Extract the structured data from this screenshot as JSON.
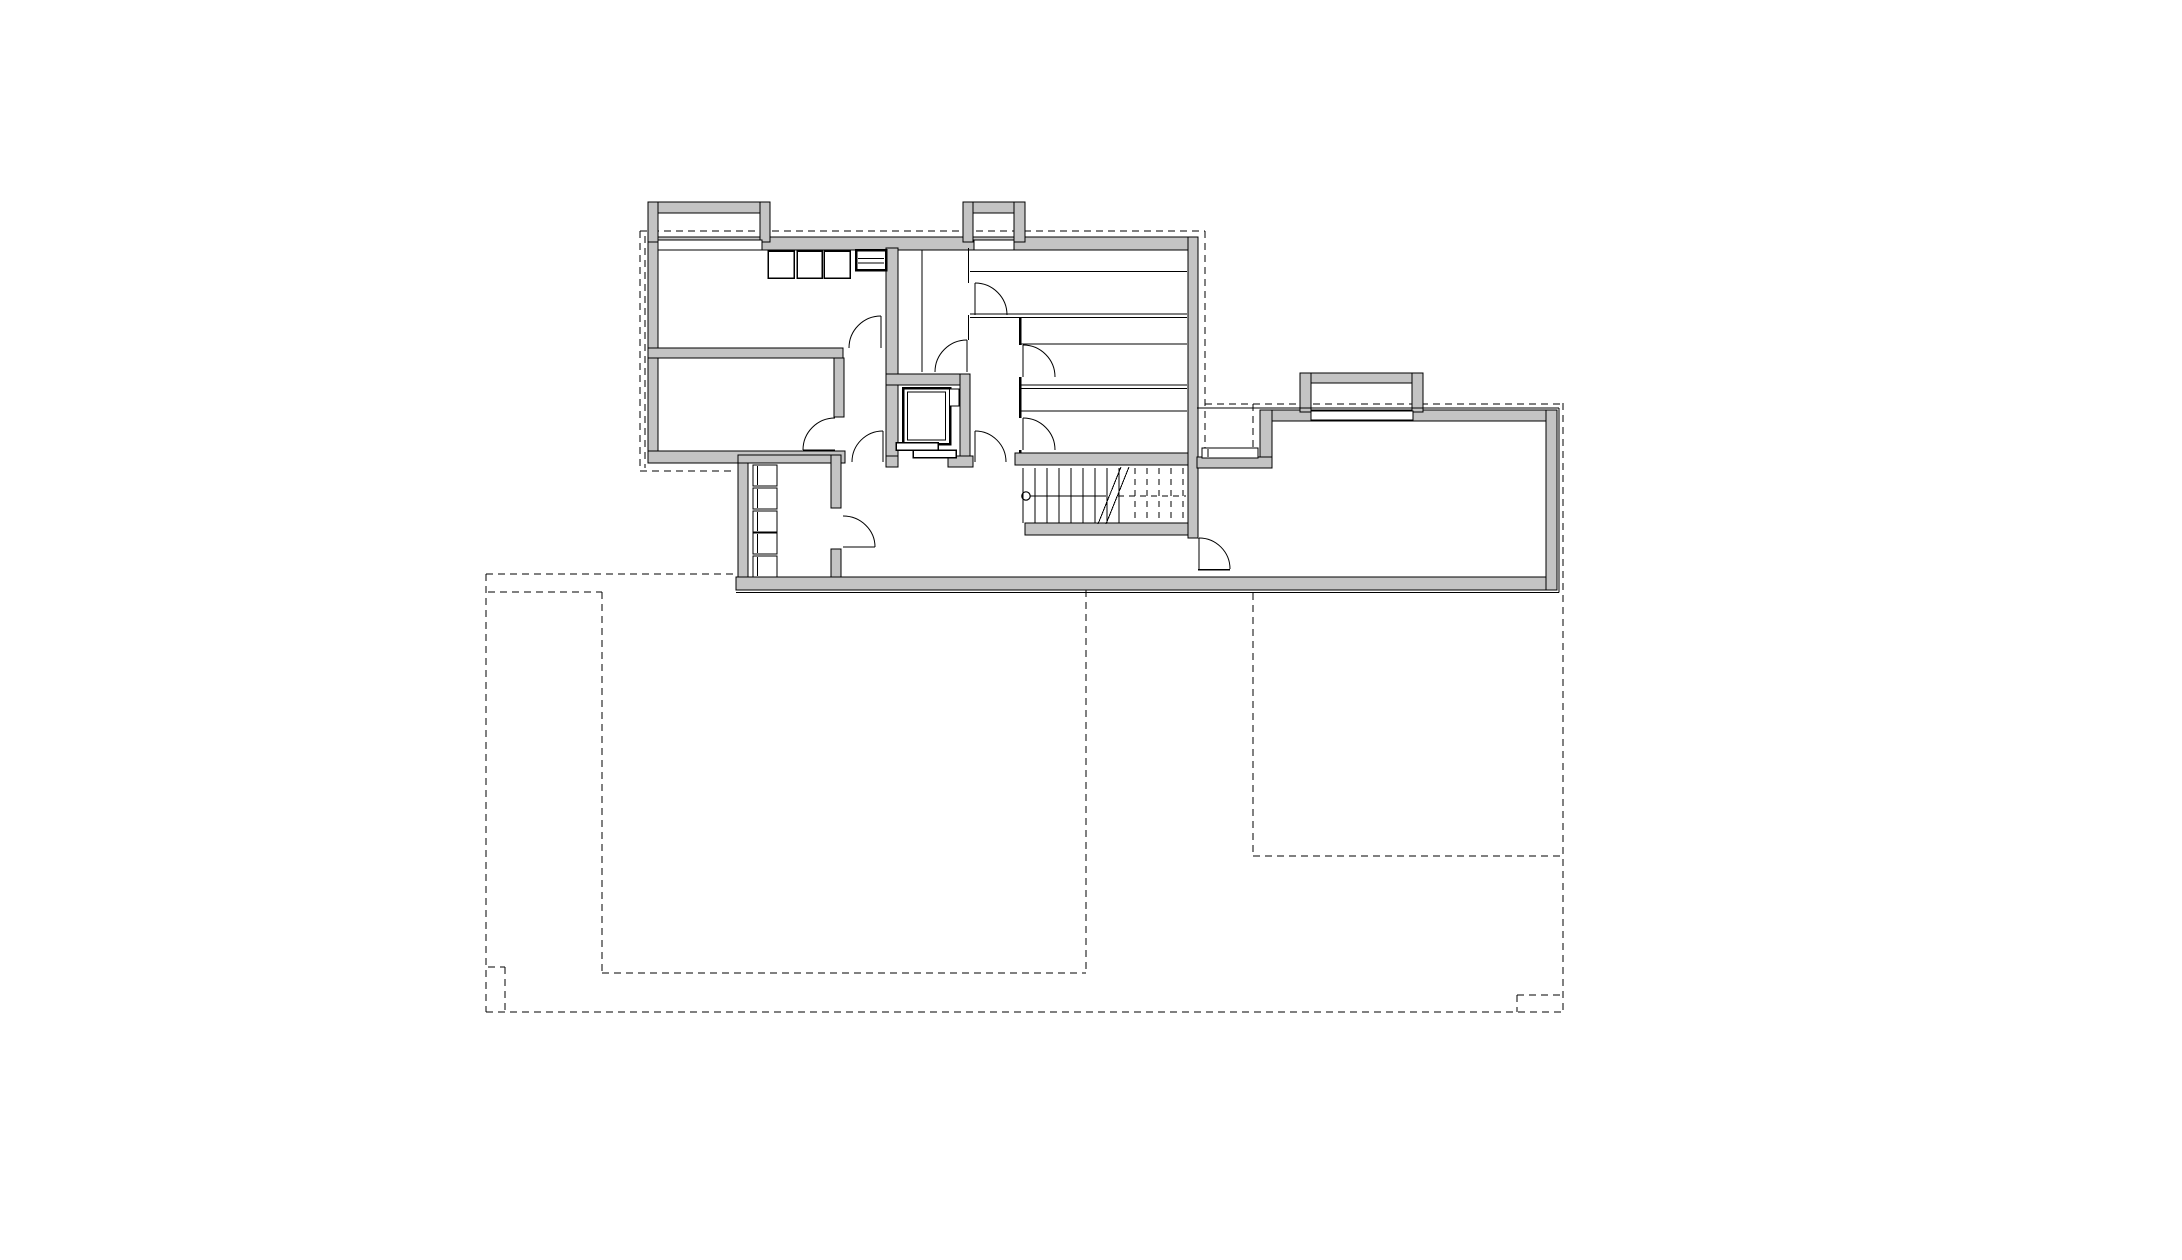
{
  "document": {
    "kind": "architectural floor plan",
    "level": "basement",
    "visible_text": "",
    "has_labels": false
  },
  "canvas": {
    "width": 2182,
    "height": 1260,
    "background": "#ffffff"
  },
  "palette": {
    "wall_fill": "#c4c4c4",
    "line": "#000000",
    "background": "#ffffff"
  },
  "plan": {
    "walls": [
      [
        648,
        237,
        550,
        13
      ],
      [
        648,
        237,
        10,
        226
      ],
      [
        1188,
        237,
        10,
        301
      ],
      [
        648,
        348,
        195,
        10
      ],
      [
        648,
        451,
        197,
        12
      ],
      [
        886,
        248,
        12,
        126
      ],
      [
        886,
        374,
        12,
        92
      ],
      [
        886,
        374,
        84,
        11
      ],
      [
        960,
        374,
        10,
        92
      ],
      [
        886,
        456,
        12,
        11
      ],
      [
        948,
        456,
        25,
        11
      ],
      [
        834,
        358,
        10,
        59
      ],
      [
        738,
        455,
        10,
        135
      ],
      [
        738,
        455,
        100,
        8
      ],
      [
        831,
        455,
        10,
        53
      ],
      [
        831,
        549,
        10,
        41
      ],
      [
        1015,
        453,
        173,
        12
      ],
      [
        1025,
        523,
        163,
        12
      ],
      [
        736,
        577,
        821,
        13
      ],
      [
        1270,
        410,
        287,
        11
      ],
      [
        1546,
        410,
        11,
        180
      ],
      [
        1260,
        410,
        12,
        58
      ],
      [
        1197,
        457,
        75,
        11
      ],
      [
        648,
        202,
        122,
        11
      ],
      [
        648,
        202,
        10,
        40
      ],
      [
        760,
        202,
        10,
        40
      ],
      [
        963,
        202,
        62,
        11
      ],
      [
        963,
        202,
        10,
        40
      ],
      [
        1014,
        202,
        11,
        40
      ],
      [
        1300,
        373,
        123,
        10
      ],
      [
        1300,
        373,
        11,
        39
      ],
      [
        1412,
        373,
        11,
        39
      ]
    ],
    "window_strips": [
      [
        658,
        240,
        104,
        10
      ],
      [
        974,
        240,
        40,
        10
      ],
      [
        1311,
        411,
        102,
        9
      ],
      [
        1202,
        448,
        56,
        10
      ]
    ],
    "interior_lines": [
      [
        922,
        250,
        922,
        372,
        1
      ],
      [
        968.5,
        248,
        968.5,
        283,
        1
      ],
      [
        968.5,
        315,
        968.5,
        340,
        1
      ],
      [
        1020,
        317,
        1020,
        345,
        2.5
      ],
      [
        1020,
        377,
        1020,
        418,
        2.5
      ],
      [
        1020,
        450,
        1020,
        453,
        2.5
      ],
      [
        970,
        271.5,
        1187,
        271.5,
        1
      ],
      [
        970,
        314,
        1187,
        314,
        1
      ],
      [
        970,
        317.5,
        1187,
        317.5,
        1
      ],
      [
        1020,
        344,
        1187,
        344,
        1
      ],
      [
        1020,
        385,
        1187,
        385,
        1
      ],
      [
        1020,
        388.5,
        1187,
        388.5,
        1
      ],
      [
        1020,
        411,
        1187,
        411,
        1
      ],
      [
        1023,
        468,
        1023,
        523,
        1
      ],
      [
        1197,
        408,
        1559,
        408,
        1
      ],
      [
        1559,
        408,
        1559,
        592.5,
        1
      ],
      [
        736,
        592.5,
        1559,
        592.5,
        1
      ],
      [
        1198,
        569.5,
        1230,
        569.5,
        1.5
      ],
      [
        1208,
        449,
        1208,
        457,
        1
      ]
    ],
    "dashed_lines": [
      [
        640,
        231,
        1205,
        231
      ],
      [
        640,
        231,
        640,
        470
      ],
      [
        645,
        236,
        645,
        468
      ],
      [
        640,
        471,
        736,
        471
      ],
      [
        486,
        574,
        736,
        574
      ],
      [
        486,
        574,
        486,
        1012
      ],
      [
        486,
        1012,
        1563,
        1012
      ],
      [
        1563,
        403,
        1563,
        1012
      ],
      [
        1205,
        404,
        1563,
        404
      ],
      [
        1205,
        231,
        1205,
        448
      ],
      [
        1253,
        404,
        1253,
        448
      ],
      [
        1253,
        593,
        1253,
        856
      ],
      [
        1253,
        856,
        1563,
        856
      ],
      [
        488,
        592,
        602,
        592
      ],
      [
        602,
        592,
        602,
        973
      ],
      [
        602,
        973,
        1086,
        973
      ],
      [
        1086,
        590,
        1086,
        973
      ],
      [
        488,
        967,
        505,
        967
      ],
      [
        505,
        967,
        505,
        1012
      ],
      [
        1517,
        995,
        1563,
        995
      ],
      [
        1517,
        995,
        1517,
        1012
      ]
    ],
    "furniture_boxes": [
      [
        768,
        251,
        26,
        27,
        1.5
      ],
      [
        797,
        251,
        25,
        27,
        1.5
      ],
      [
        824,
        251,
        26,
        27,
        1.5
      ],
      [
        856,
        250,
        30,
        20,
        2.5
      ],
      [
        753,
        465,
        24,
        21,
        1.2
      ],
      [
        753,
        488,
        24,
        21,
        1.2
      ],
      [
        753,
        511,
        24,
        21,
        1.2
      ],
      [
        753,
        533,
        24,
        21,
        1.2
      ],
      [
        753,
        556,
        24,
        21,
        1.2
      ]
    ],
    "furniture_lines": [
      [
        858,
        258.5,
        884,
        258.5,
        1
      ],
      [
        858,
        263,
        884,
        263,
        1
      ],
      [
        757.5,
        466,
        757.5,
        485,
        1
      ],
      [
        757.5,
        489,
        757.5,
        508,
        1
      ],
      [
        757.5,
        512,
        757.5,
        531,
        1
      ],
      [
        757.5,
        534,
        757.5,
        553,
        1
      ],
      [
        757.5,
        557,
        757.5,
        576,
        1
      ]
    ],
    "doors": [
      {
        "name": "door-room-upper-left",
        "leaf": [
          881,
          316,
          881,
          348
        ],
        "arc": "M 849 348 A 32 32 0 0 1 881 316"
      },
      {
        "name": "door-room-lower-left",
        "leaf": [
          803,
          450,
          835,
          450
        ],
        "arc": "M 803 450 A 32 32 0 0 1 835 418"
      },
      {
        "name": "door-annex-room",
        "leaf": [
          843,
          547,
          875,
          547
        ],
        "arc": "M 875 547 A 32 31 0 0 0 843 516"
      },
      {
        "name": "door-hall-west",
        "leaf": [
          883,
          431,
          883,
          462
        ],
        "arc": "M 883 431 A 31 31 0 0 0 852 462"
      },
      {
        "name": "door-hall-east",
        "leaf": [
          975,
          431,
          975,
          462
        ],
        "arc": "M 975 431 A 31 31 0 0 1 1006 462"
      },
      {
        "name": "door-narrow-room",
        "leaf": [
          967,
          340,
          967,
          372
        ],
        "arc": "M 935 372 A 32 32 0 0 1 967 340"
      },
      {
        "name": "door-storage-1",
        "leaf": [
          975,
          283,
          975,
          315
        ],
        "arc": "M 975 283 A 32 32 0 0 1 1007 315"
      },
      {
        "name": "door-storage-2",
        "leaf": [
          1023,
          345,
          1023,
          377
        ],
        "arc": "M 1023 345 A 32 32 0 0 1 1055 377"
      },
      {
        "name": "door-storage-3",
        "leaf": [
          1023,
          418,
          1023,
          450
        ],
        "arc": "M 1023 418 A 32 32 0 0 1 1055 450"
      },
      {
        "name": "door-wing-passage",
        "leaf": [
          1199,
          538,
          1199,
          569
        ],
        "arc": "M 1199 538 A 31 31 0 0 1 1230 569"
      }
    ],
    "stair": {
      "tread_y_top": 468,
      "tread_y_bottom": 523,
      "treads_solid_x": [
        1035,
        1047,
        1059,
        1071,
        1083,
        1095,
        1107,
        1119
      ],
      "treads_dashed_x": [
        1135,
        1147,
        1159,
        1171,
        1183
      ],
      "midline_solid": [
        1030,
        496,
        1106,
        496
      ],
      "midline_dashed": [
        1118,
        496,
        1186,
        496
      ],
      "start_circle": [
        1026,
        496,
        4.2
      ],
      "break_lines": [
        [
          1098,
          524,
          1121,
          467
        ],
        [
          1106,
          524,
          1129,
          467
        ]
      ]
    },
    "elevator": {
      "car": [
        903,
        388,
        47,
        56
      ],
      "car_inner": [
        907.5,
        392,
        38,
        48
      ],
      "counterweight": [
        949.5,
        389,
        9.5,
        17
      ],
      "door_panels": [
        [
          896,
          442.5,
          42,
          7.5
        ],
        [
          913,
          450,
          43,
          7.5
        ]
      ]
    }
  }
}
